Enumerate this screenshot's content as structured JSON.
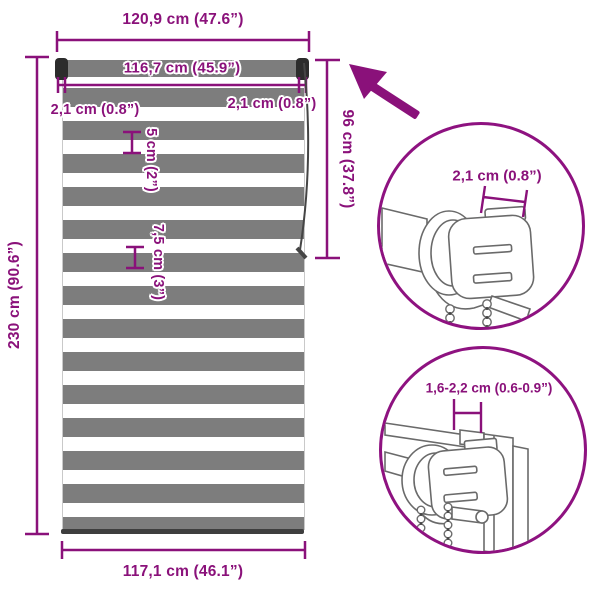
{
  "diagram_title": "zebra-roller-blind-dimension-diagram",
  "colors": {
    "accent": "#8A117A",
    "circle_stroke": "#8E1280",
    "stripe_gray": "#7D7D7D",
    "roller_cap": "#2C2C2C",
    "bottom_bar": "#3E3E3E",
    "line_art": "#6A6A6A",
    "chain": "#454545"
  },
  "dimensions": {
    "total_width": "120,9 cm (47.6”)",
    "roller_width": "116,7 cm (45.9”)",
    "left_offset": "2,1 cm (0.8”)",
    "right_offset": "2,1 cm (0.8”)",
    "sheer_stripe": "5 cm (2”)",
    "solid_stripe": "7,5 cm (3”)",
    "height": "230 cm (90.6”)",
    "chain_length": "96 cm (37.8”)",
    "fabric_width": "117,1 cm (46.1”)"
  },
  "details": {
    "bracket_depth": "2,1 cm (0.8”)",
    "clamp_range": "1,6-2,2 cm (0.6-0.9”)"
  }
}
